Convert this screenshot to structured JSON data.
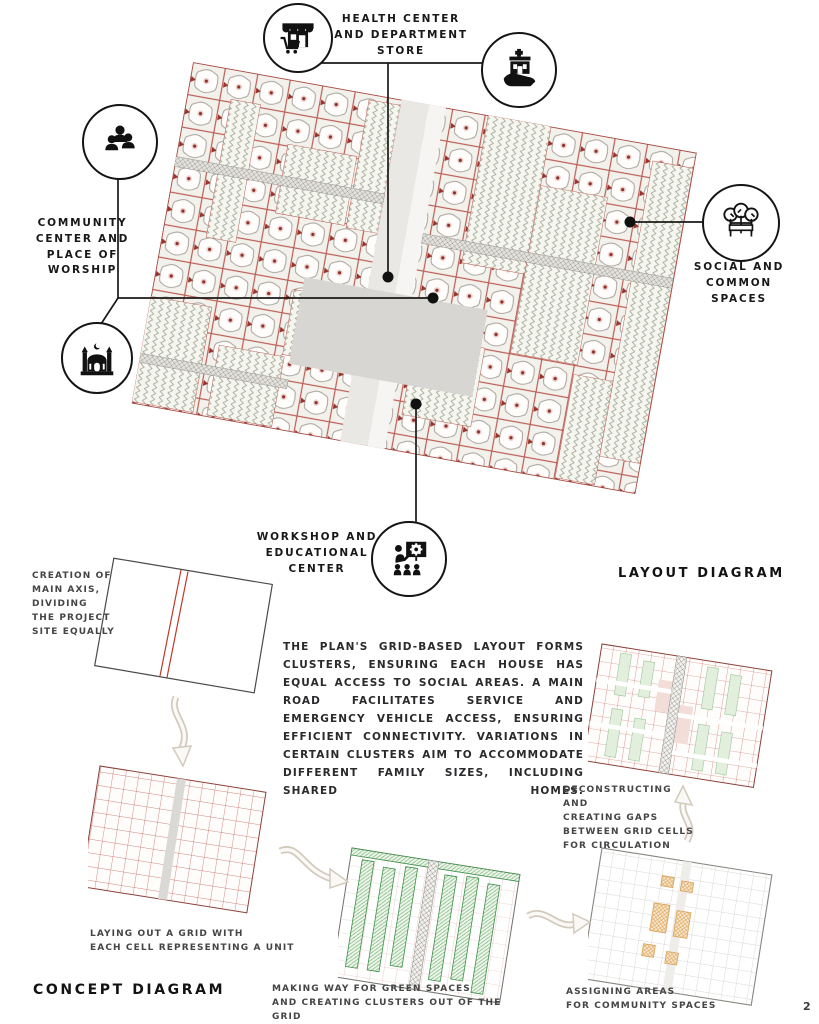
{
  "page": {
    "number": "2"
  },
  "layout_diagram": {
    "title": "LAYOUT DIAGRAM",
    "callouts": {
      "health": {
        "label": "HEALTH CENTER\nAND DEPARTMENT\nSTORE",
        "icons": [
          "department-store-icon",
          "health-center-icon"
        ]
      },
      "community": {
        "label": "COMMUNITY\nCENTER AND\nPLACE OF\nWORSHIP",
        "icons": [
          "people-group-icon",
          "mosque-icon"
        ]
      },
      "social": {
        "label": "SOCIAL AND\nCOMMON\nSPACES",
        "icons": [
          "trees-bench-icon"
        ]
      },
      "workshop": {
        "label": "WORKSHOP AND\nEDUCATIONAL\nCENTER",
        "icons": [
          "presentation-icon"
        ]
      }
    }
  },
  "concept_diagram": {
    "title": "CONCEPT DIAGRAM",
    "description": "THE PLAN'S GRID-BASED LAYOUT FORMS CLUSTERS, ENSURING EACH HOUSE HAS EQUAL ACCESS TO SOCIAL AREAS. A MAIN ROAD FACILITATES SERVICE AND EMERGENCY VEHICLE ACCESS, ENSURING EFFICIENT CONNECTIVITY. VARIATIONS IN CERTAIN CLUSTERS AIM TO ACCOMMODATE DIFFERENT FAMILY SIZES, INCLUDING SHARED HOMES.",
    "steps": [
      {
        "caption": "CREATION OF\nMAIN AXIS,\nDIVIDING\nTHE PROJECT\nSITE EQUALLY"
      },
      {
        "caption": "LAYING OUT A GRID WITH\nEACH CELL REPRESENTING A UNIT"
      },
      {
        "caption": "MAKING WAY FOR GREEN SPACES\nAND CREATING CLUSTERS OUT OF THE GRID"
      },
      {
        "caption": "ASSIGNING AREAS\nFOR COMMUNITY SPACES"
      },
      {
        "caption": "DECONSTRUCTING AND\nCREATING GAPS\nBETWEEN GRID CELLS\nFOR CIRCULATION"
      }
    ]
  },
  "colors": {
    "plan_grid_red": "#b5544d",
    "accent_dark_red": "#8e1f1a",
    "green": "#4a9e55",
    "orange": "#dc9e4e",
    "road_gray": "#dcdad6",
    "line_black": "#1a1a1a"
  }
}
